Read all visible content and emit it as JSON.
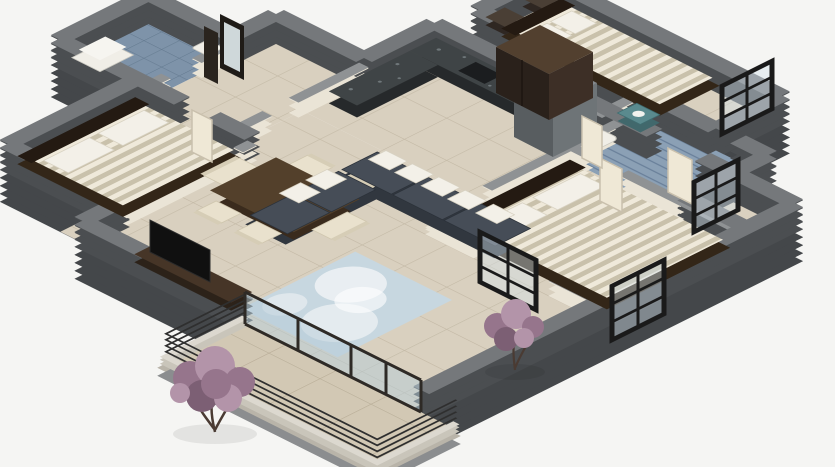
{
  "scene": {
    "type": "3d-isometric-floor-plan-render",
    "description": "Cutaway 3D render of an apartment floor plan on a plain light background; no text labels are rendered",
    "rooms": [
      {
        "name": "living-room",
        "furniture": [
          "l-shaped-sectional-sofa",
          "white-throw-pillows",
          "light-blue-area-rug",
          "tv-wall-unit"
        ]
      },
      {
        "name": "dining-area",
        "furniture": [
          "dark-wood-dining-table",
          "six-cream-chairs"
        ]
      },
      {
        "name": "kitchen",
        "furniture": [
          "granite-l-shaped-counter",
          "tall-steel-column-unit",
          "sink"
        ]
      },
      {
        "name": "bedroom-left",
        "furniture": [
          "double-bed-striped-bedding",
          "white-pillows"
        ]
      },
      {
        "name": "bedroom-master",
        "furniture": [
          "double-bed-striped-bedding",
          "two-nightstands",
          "dark-wardrobe"
        ]
      },
      {
        "name": "bedroom-center",
        "furniture": [
          "double-bed-striped-bedding",
          "white-pillows"
        ]
      },
      {
        "name": "bathroom-small",
        "furniture": [
          "bathtub",
          "sink",
          "tall-mirror-cabinet"
        ]
      },
      {
        "name": "bathroom-main",
        "furniture": [
          "toilet",
          "teal-vanity"
        ]
      },
      {
        "name": "hallway-entry",
        "furniture": [
          "open-door-leaves"
        ]
      },
      {
        "name": "balcony-terrace",
        "furniture": [
          "glass-sliding-doors",
          "two-flowering-trees",
          "stacked-metal-railings"
        ]
      }
    ],
    "windows": [
      "master-east-grid-window",
      "main-bath-east-grid-window",
      "center-bedroom-east-grid-window",
      "center-bedroom-south-grid-window"
    ]
  },
  "palette": {
    "background": "#f5f5f3",
    "foundation": "#44474a",
    "wall_face_outer": "#4b4e51",
    "wall_top_outer": "#75787b",
    "wall_face_inner": "#eae4d6",
    "wall_top_inner": "#8f9294",
    "floor_tile": "#d9d0bf",
    "floor_grout": "#c3b9a5",
    "balcony_tile": "#d2c8b4",
    "balcony_grout": "#b9ae98",
    "bath_tile": "#7e93a9",
    "bath_grout": "#62788e",
    "bath2_tile": "#8ba0b5",
    "bath2_grout": "#69809a",
    "rug_base": "#c7d7e0",
    "rug_blotch": "#eef2f4",
    "sofa_base": "#31373f",
    "sofa_cushion": "#464d57",
    "pillow": "#f3f0e8",
    "wood_dark": "#332618",
    "wood_mid": "#53402b",
    "bedding_light": "#efe9da",
    "bedding_dark": "#c9c1ab",
    "granite": "#3f4446",
    "granite_speck": "#788084",
    "fridge_face": "#585d60",
    "fridge_side": "#6e7477",
    "fridge_top": "#84898d",
    "glass": "#b6cbd7",
    "window_frame": "#1a1a1a",
    "plant_dark": "#7c5f74",
    "plant_mid": "#96758c",
    "plant_light": "#b394a9",
    "teal": "#5a8a8e",
    "white_fixture": "#f0eee7",
    "tv_black": "#101010",
    "stair_rail": "#2f2f2f",
    "parapet": "#c9c5ba",
    "parapet_top": "#dcd8cf",
    "door_leaf": "#efe8d6",
    "mirror_glass": "#cfd8da"
  }
}
